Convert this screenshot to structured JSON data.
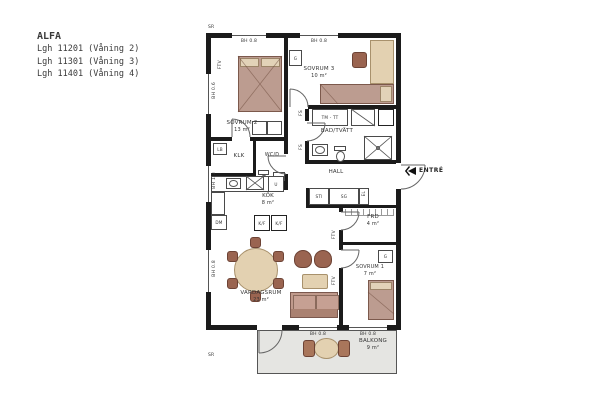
{
  "title_block": {
    "name": "ALFA",
    "units": [
      "Lgh 11201 (Våning 2)",
      "Lgh 11301 (Våning 3)",
      "Lgh 11401 (Våning 4)"
    ]
  },
  "entrance": {
    "label": "ENTRÉ"
  },
  "rooms": {
    "sovrum1": {
      "name": "SOVRUM 1",
      "area": "7 m²"
    },
    "sovrum2": {
      "name": "SOVRUM 2",
      "area": "13 m²"
    },
    "sovrum3": {
      "name": "SOVRUM 3",
      "area": "10 m²"
    },
    "badtvatt": {
      "name": "BAD/TVÄTT"
    },
    "hall": {
      "name": "HALL"
    },
    "kok": {
      "name": "KÖK",
      "area": "8 m²"
    },
    "klk": {
      "name": "KLK"
    },
    "wcd": {
      "name": "WC/D"
    },
    "frd": {
      "name": "FRD",
      "area": "4 m²"
    },
    "vardagsrum": {
      "name": "VARDAGSRUM",
      "area": "23 m²"
    },
    "balkong": {
      "name": "BALKONG",
      "area": "9 m²"
    }
  },
  "fixtures": {
    "tm_tt": "TM - TT",
    "dm": "DM",
    "kf": "K/F",
    "u": "U",
    "g": "G",
    "lb": "LB",
    "sg": "SG",
    "sti": "STI",
    "el": "EL",
    "fs": "FS",
    "ftv": "FTV",
    "sr": "SR"
  },
  "window_labels": {
    "bh06": "BH 0.6",
    "bh08": "BH 0.8",
    "bh13": "BH 1.3"
  },
  "colors": {
    "wall": "#1b1b1b",
    "bed": "#bc9c90",
    "wood": "#e3d1b1",
    "balcony": "#e5e5e2"
  }
}
